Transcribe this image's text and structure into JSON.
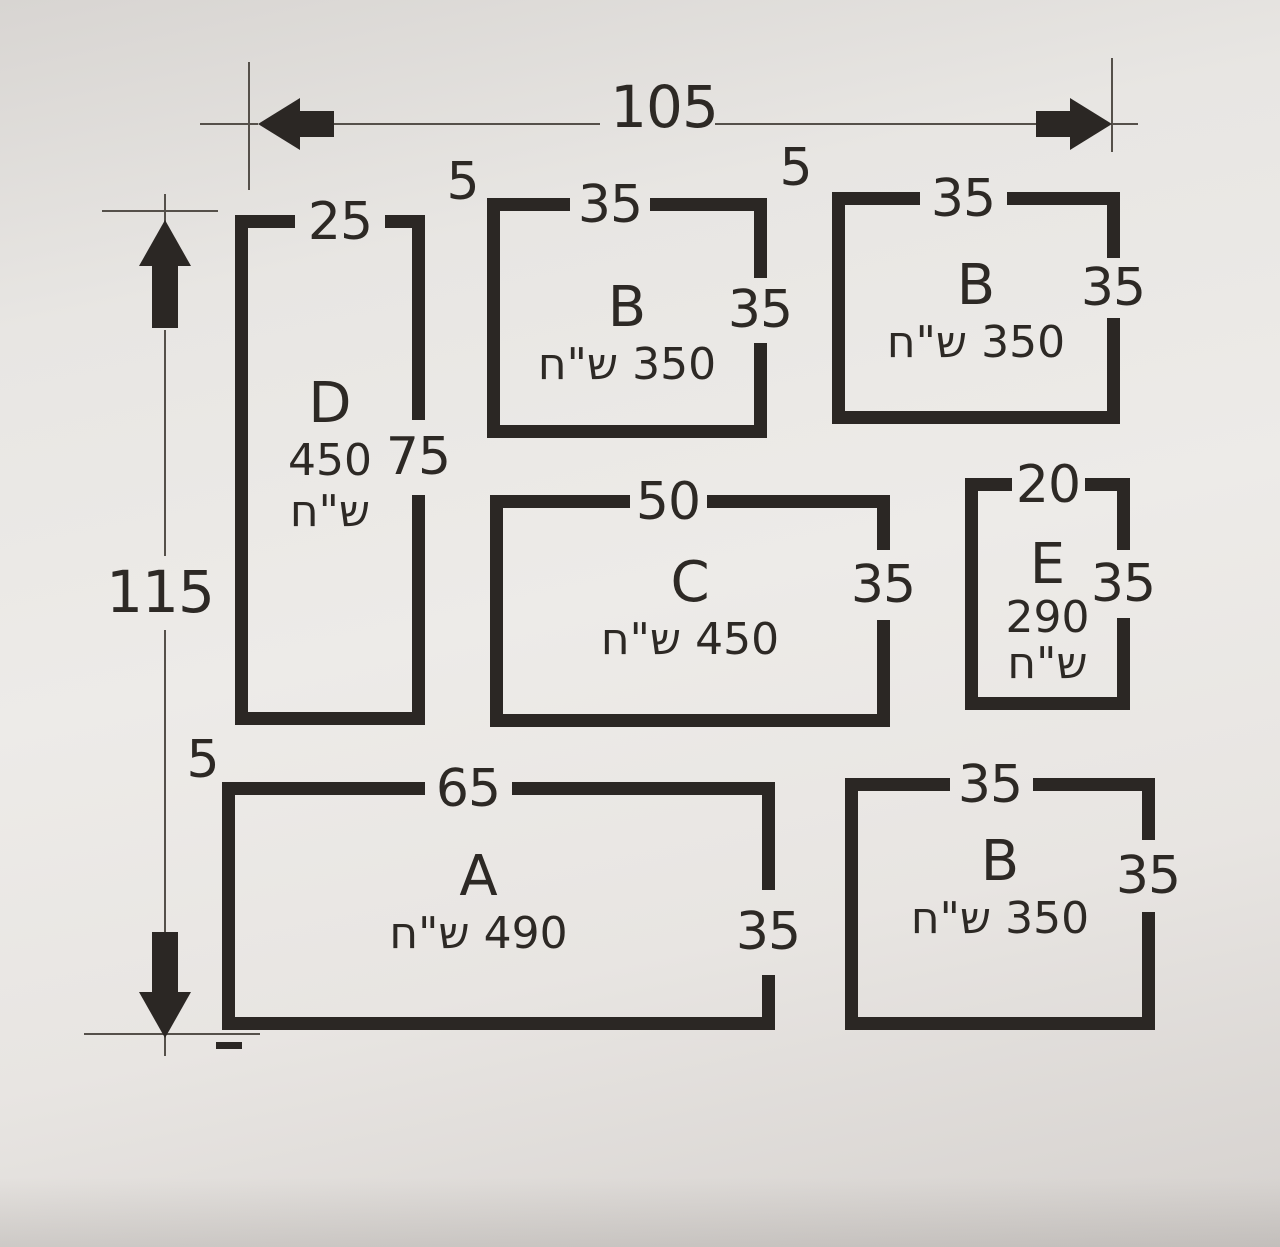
{
  "dimension_lines": {
    "overall_width": "105",
    "overall_height": "115"
  },
  "gap_labels": {
    "top_left": "5",
    "top_right": "5",
    "bottom_left": "5"
  },
  "plots": [
    {
      "id": "D",
      "label": "D",
      "price_value": "450",
      "price_currency": "ש\"ח",
      "top_dim": "25",
      "side_dim": "75"
    },
    {
      "id": "B-top-middle",
      "label": "B",
      "price": "350 ש\"ח",
      "top_dim": "35",
      "side_dim": "35"
    },
    {
      "id": "B-top-right",
      "label": "B",
      "price": "350 ש\"ח",
      "top_dim": "35",
      "side_dim": "35"
    },
    {
      "id": "C",
      "label": "C",
      "price": "450 ש\"ח",
      "top_dim": "50",
      "side_dim": "35"
    },
    {
      "id": "E",
      "label": "E",
      "price_value": "290",
      "price_currency": "ש\"ח",
      "top_dim": "20",
      "side_dim": "35"
    },
    {
      "id": "A",
      "label": "A",
      "price": "490 ש\"ח",
      "top_dim": "65",
      "side_dim": "35"
    },
    {
      "id": "B-bottom-right",
      "label": "B",
      "price": "350 ש\"ח",
      "top_dim": "35",
      "side_dim": "35"
    }
  ],
  "colors": {
    "ink": "#2b2724",
    "paper": "#e9e7e4",
    "thin_line": "#55504a"
  }
}
